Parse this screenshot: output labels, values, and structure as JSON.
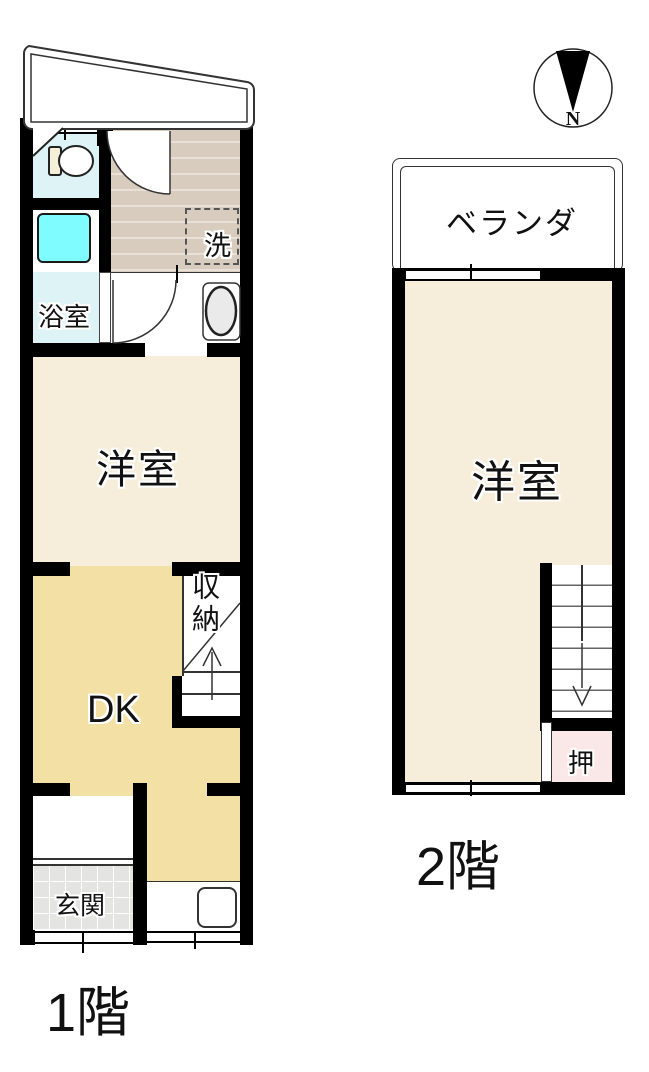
{
  "plan_title": "住宅間取り図",
  "floor1": {
    "name_label": "1階",
    "western_room": "洋室",
    "dk": "DK",
    "bath": "浴室",
    "wash_machine": "洗",
    "storage": "収納",
    "entrance": "玄関"
  },
  "floor2": {
    "name_label": "2階",
    "veranda": "ベランダ",
    "western_room": "洋室",
    "closet": "押"
  },
  "compass": {
    "north": "N"
  },
  "colors": {
    "wall": "#000000",
    "cream_room": "#f6eedb",
    "dk_tan": "#f3e0a5",
    "bath_cyan": "#ddf3f6",
    "tub_cyan": "#7efcff",
    "wash_area_taupe": "#d8ccbf",
    "entrance_tile": "#e4e4e2",
    "closet_pink": "#f9e8e7"
  }
}
